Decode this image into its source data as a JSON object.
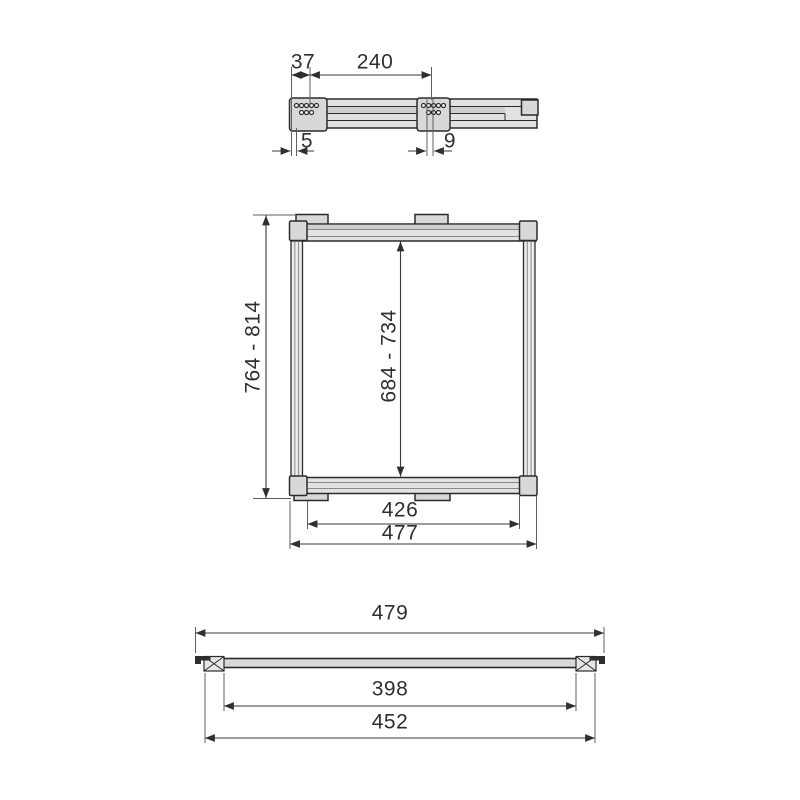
{
  "drawing": {
    "type": "technical-dimension-drawing",
    "views": {
      "top_view": {
        "description": "telescopic rail side view with two drilled mounting brackets",
        "dim_end_to_first_bracket": "37",
        "dim_between_brackets": "240",
        "dim_end_inset": "5",
        "dim_bracket_hole_offset": "9"
      },
      "front_view": {
        "description": "adjustable square frame with corner connectors and mounting tabs",
        "dim_overall_height_range": "764 - 814",
        "dim_inner_height_range": "684 - 734",
        "dim_inner_width": "426",
        "dim_overall_width": "477"
      },
      "bottom_view": {
        "description": "crossbar section view with hatched end caps",
        "dim_overall_width": "479",
        "dim_inner_width": "398",
        "dim_mounting_width": "452"
      }
    },
    "colors": {
      "line": "#2b2b2b",
      "dimension": "#3a3a3a",
      "extension": "#606060",
      "fill_light": "#e2e2e2",
      "fill_mid": "#cfcfcf",
      "fill_block": "#d8d8d8",
      "text": "#2f2f2f",
      "background": "#ffffff"
    }
  }
}
